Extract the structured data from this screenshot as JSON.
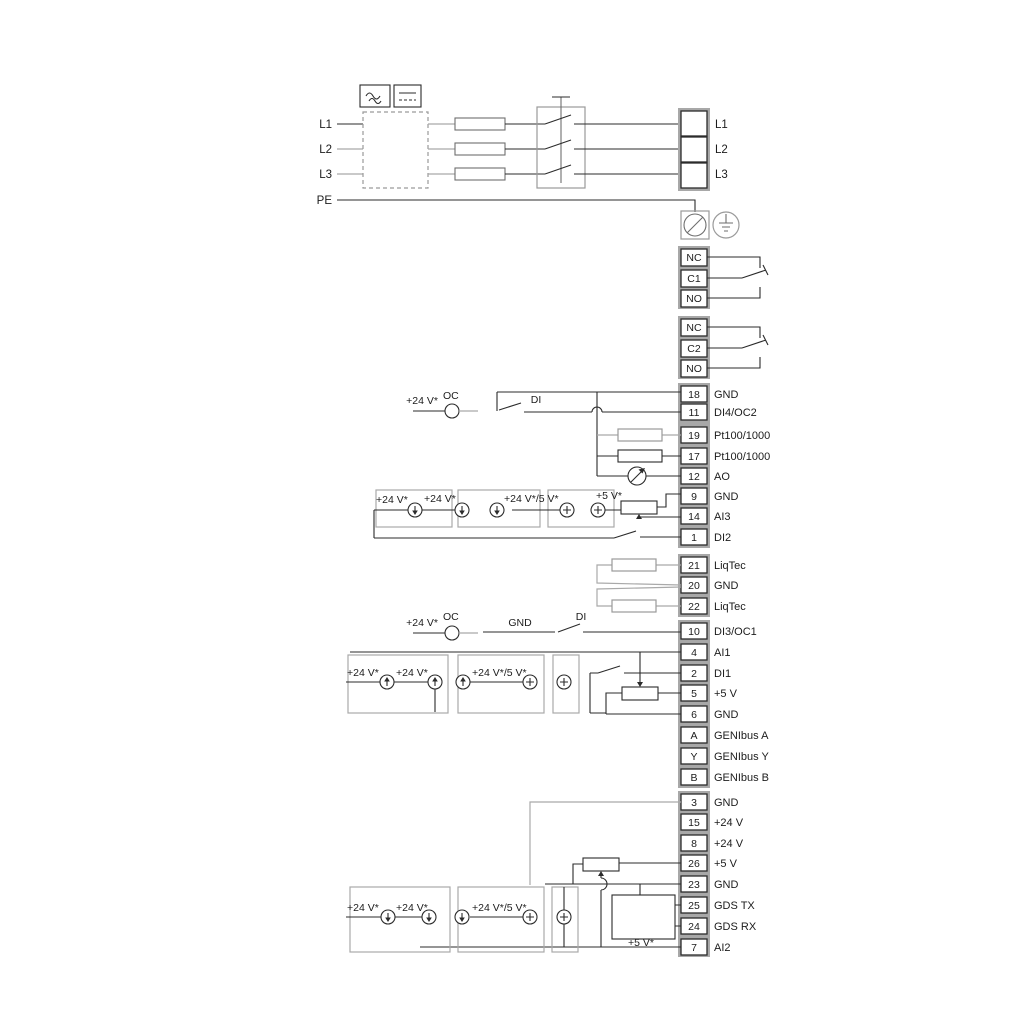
{
  "diagram_type": "pump-controller-wiring-diagram",
  "colors": {
    "wire_dark": "#2b2b2b",
    "wire_grey": "#a9a9a9",
    "terminal_backing": "#a8a8a8",
    "text": "#1c1c1c"
  },
  "power": {
    "inputs": [
      "L1",
      "L2",
      "L3",
      "PE"
    ],
    "outputs": [
      "L1",
      "L2",
      "L3"
    ]
  },
  "relays": [
    {
      "rows": [
        "NC",
        "C1",
        "NO"
      ]
    },
    {
      "rows": [
        "NC",
        "C2",
        "NO"
      ]
    }
  ],
  "labels": {
    "v24": "+24 V*",
    "v24or5": "+24 V*/5 V*",
    "v5": "+5 V*",
    "oc": "OC",
    "di": "DI",
    "gnd": "GND"
  },
  "icons": [
    "ac-symbol",
    "dc-symbol",
    "fuse",
    "disconnect-switch",
    "screw-terminal",
    "earth-ground",
    "current-source",
    "voltage-source",
    "potentiometer",
    "resistor-sensor",
    "analog-meter",
    "gds-sensor-box",
    "relay-changeover-contact"
  ],
  "terminals": [
    {
      "n": "18",
      "t": "GND"
    },
    {
      "n": "11",
      "t": "DI4/OC2"
    },
    {
      "n": "19",
      "t": "Pt100/1000"
    },
    {
      "n": "17",
      "t": "Pt100/1000"
    },
    {
      "n": "12",
      "t": "AO"
    },
    {
      "n": "9",
      "t": "GND"
    },
    {
      "n": "14",
      "t": "AI3"
    },
    {
      "n": "1",
      "t": "DI2"
    },
    {
      "n": "21",
      "t": "LiqTec"
    },
    {
      "n": "20",
      "t": "GND"
    },
    {
      "n": "22",
      "t": "LiqTec"
    },
    {
      "n": "10",
      "t": "DI3/OC1"
    },
    {
      "n": "4",
      "t": "AI1"
    },
    {
      "n": "2",
      "t": "DI1"
    },
    {
      "n": "5",
      "t": "+5 V"
    },
    {
      "n": "6",
      "t": "GND"
    },
    {
      "n": "A",
      "t": "GENIbus A"
    },
    {
      "n": "Y",
      "t": "GENIbus Y"
    },
    {
      "n": "B",
      "t": "GENIbus B"
    },
    {
      "n": "3",
      "t": "GND"
    },
    {
      "n": "15",
      "t": "+24 V"
    },
    {
      "n": "8",
      "t": "+24 V"
    },
    {
      "n": "26",
      "t": "+5 V"
    },
    {
      "n": "23",
      "t": "GND"
    },
    {
      "n": "25",
      "t": "GDS TX"
    },
    {
      "n": "24",
      "t": "GDS RX"
    },
    {
      "n": "7",
      "t": "AI2"
    }
  ]
}
